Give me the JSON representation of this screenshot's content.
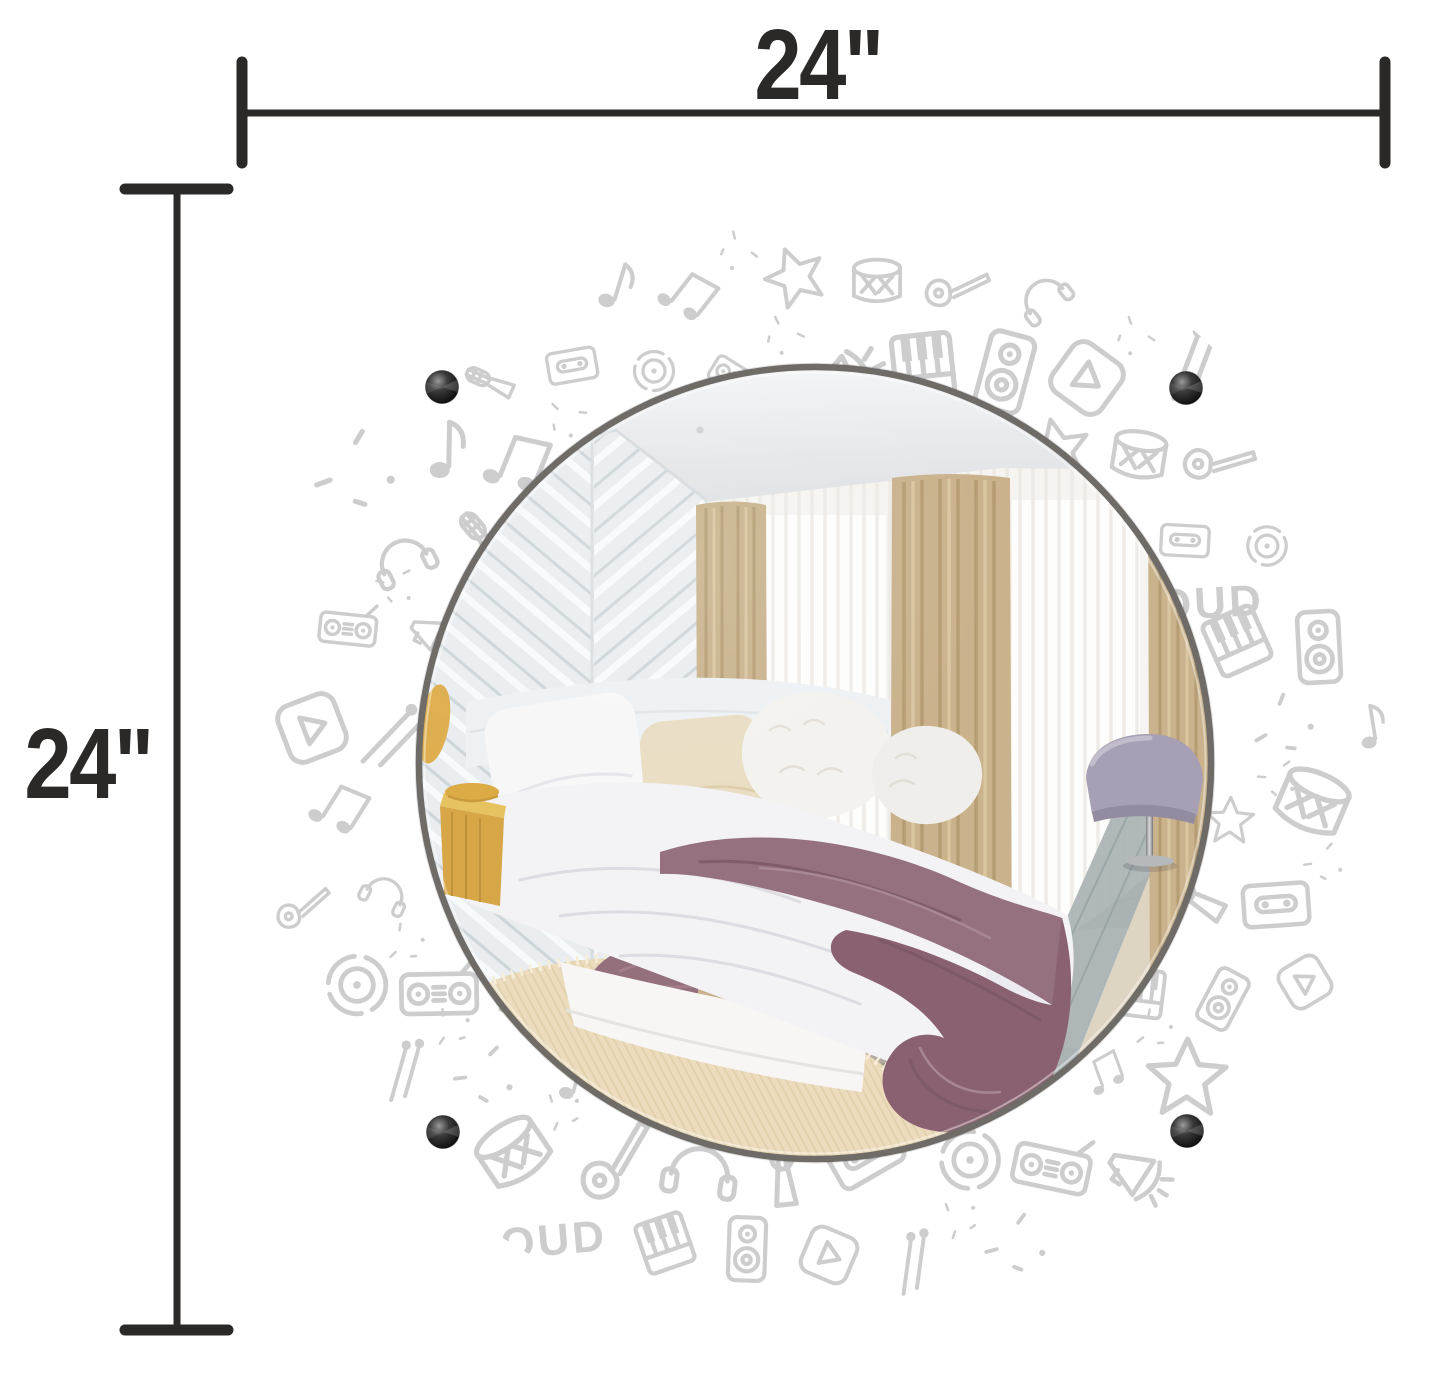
{
  "page": {
    "background": "#ffffff"
  },
  "dimensions": {
    "width_label": "24\"",
    "height_label": "24\"",
    "ink_color": "#2a2927"
  },
  "mirror": {
    "alt": "round mirror reflecting a bedroom",
    "rim_color": "#6f6c68",
    "standoff_color": "#141414",
    "standoffs": [
      "top-left",
      "top-right",
      "bottom-left",
      "bottom-right"
    ]
  },
  "pattern": {
    "word": "LOUD",
    "ink_color": "#cdcdcd",
    "icons": [
      "music-note",
      "beamed-notes",
      "star",
      "drum",
      "guitar",
      "headphones",
      "microphone",
      "cassette-tape",
      "vinyl-record",
      "boombox",
      "megaphone",
      "piano-keys",
      "speaker",
      "play-button",
      "drumstick",
      "sparkle"
    ]
  },
  "scene": {
    "alt": "bedroom reflection: white herringbone plank wall, white bedding with plum knit throw, tan curtains with sheers, cream rug, plum oval rug, lavender chair, yellow nightstand",
    "colors": {
      "base": "#eef0f1",
      "ceiling_hi": "#f4f5f6",
      "ceiling_lo": "#dee0e3",
      "wall": "#e9edf0",
      "wall_line": "#ccd5da",
      "corner": "#d8dde0",
      "sheer": "#f6f4f0",
      "window": "#fdfdfb",
      "curtain": "#c9b28c",
      "curtain_dark": "#b2986f",
      "curtain_light": "#dbc7a3",
      "bedding": "#f3f2f4",
      "bedding_fold": "#dddce3",
      "mattress": "#f7f6f4",
      "pillow_white": "#f8f7f7",
      "pillow_cream": "#e9ddc3",
      "pillow_fluff": "#f4f2ee",
      "headboard": "#eef1f3",
      "throw": "#947080",
      "throw_deep": "#8a6171",
      "throw_fold": "#7b5765",
      "throw_light": "#ab8b98",
      "rug": "#ecdcbd",
      "rug_line": "#dcc9a3",
      "rug_fringe": "#f6eed9",
      "rug_right": "#ded4c2",
      "floor_dark": "#6a584a",
      "floor_mid": "#a89a8c",
      "floor_light": "#c0b9af",
      "floor_gray": "#a9b2b4",
      "floor_gray_line": "#95a1a4",
      "accent_rug": "#94707d",
      "accent_rug_line": "#a8818f",
      "accent_rug_dark": "#7b5968",
      "chair": "#a79fb3",
      "chair_light": "#c3bccd",
      "chair_dark": "#938ba0",
      "nightstand": "#d6a647",
      "nightstand_top": "#e7c261",
      "nightstand_line": "#bf923c",
      "lamp": "#ddab45"
    }
  }
}
